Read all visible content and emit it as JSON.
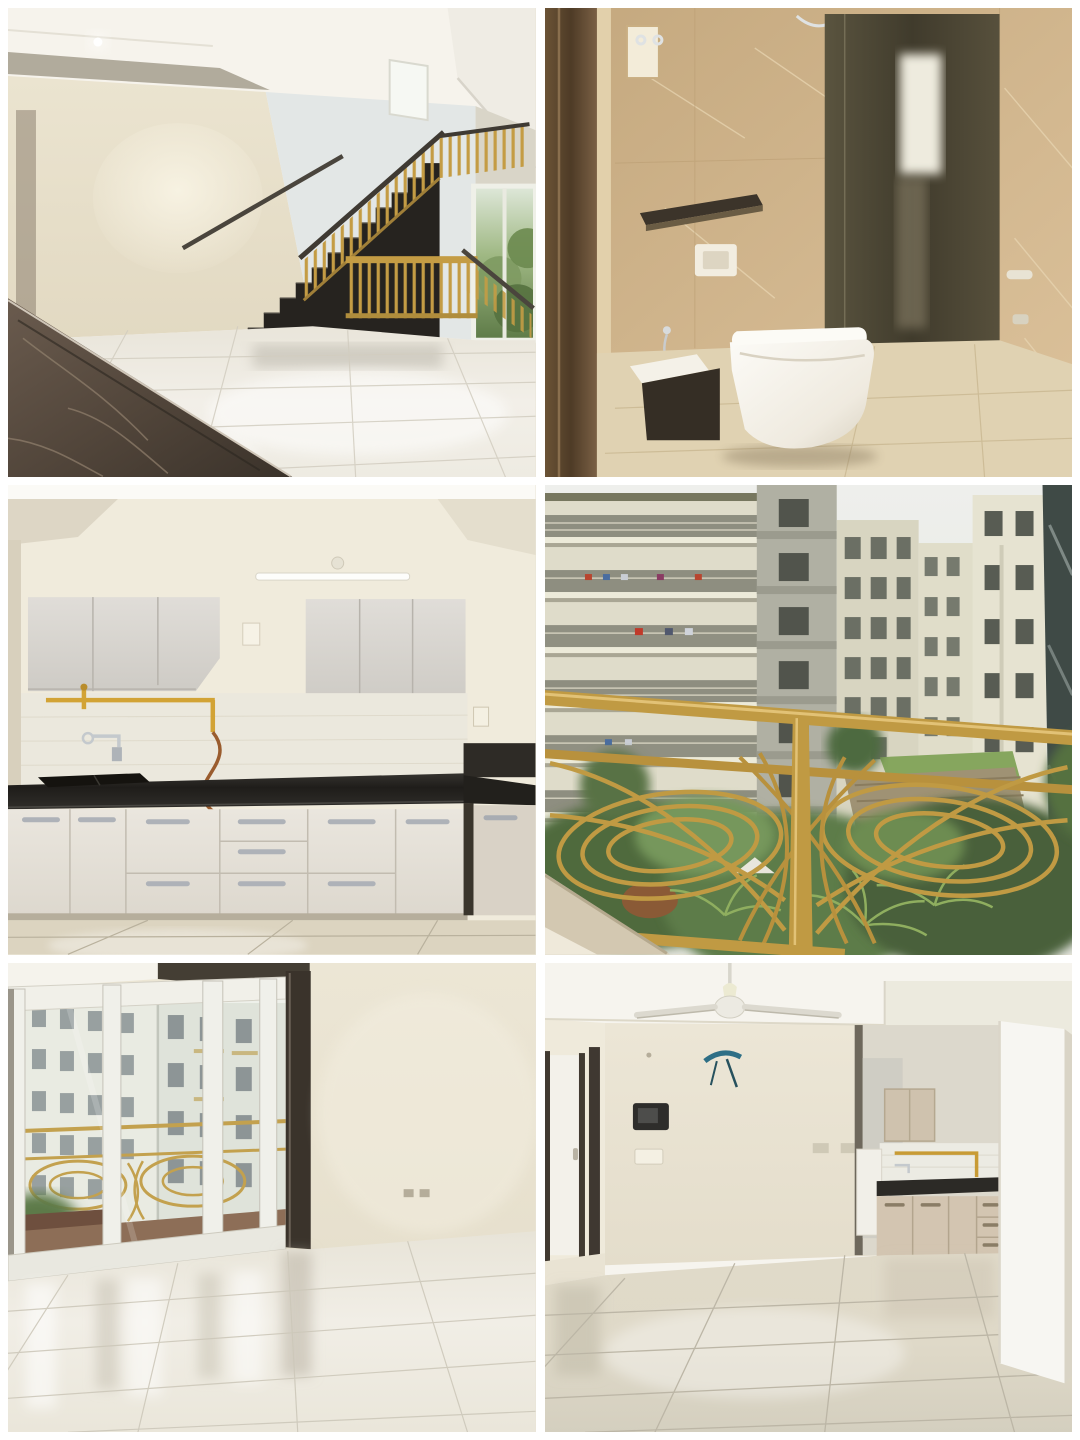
{
  "page": {
    "title": "Apartment listing photo collage",
    "type": "photo-collage",
    "background_color": "#ffffff",
    "grid": {
      "rows": 3,
      "columns": 2,
      "outer_border_px": 8,
      "gutter_px": 9
    }
  },
  "panels": [
    {
      "id": "living-hall-staircase",
      "position": "top-left",
      "description": "Empty duplex living hall with glossy white tile floor, dark brown marble inlay in the corner, cream walls with cove ceiling and downlight, black staircase with golden balustrade and a window showing greenery",
      "colors": {
        "wall": "#ece5d1",
        "ceiling": "#f6f3ec",
        "floor": "#f1eee6",
        "stairs": "#26231f",
        "railing_gold": "#c49c44",
        "marble": "#4e4339",
        "window_green": "#7e9a62"
      }
    },
    {
      "id": "bathroom",
      "position": "top-right",
      "description": "Bathroom with beige marble wall tiles, wall-hung white toilet, dark granite niche shelf, dark glass shower partition reflecting a bright window, and dark wooden door jamb",
      "colors": {
        "tile": "#cdb186",
        "glass": "#4b4636",
        "toilet": "#f7f5ef",
        "granite": "#39322a",
        "floor": "#e0d2b2",
        "door_jamb": "#5a452f"
      }
    },
    {
      "id": "kitchen",
      "position": "middle-left",
      "description": "Modular kitchen with light wood-grain upper and lower cabinets, chrome handles, black granite countertop with sink, wall-mounted chrome tap, yellow gas pipeline with copper hose, tube light and beige tiled floor",
      "colors": {
        "wall": "#f0ebdc",
        "cabinet": "#dedbd6",
        "counter": "#23211e",
        "gas_pipe": "#d2a335",
        "hose": "#9a5c2e",
        "handle": "#aeb2b8",
        "floor": "#dcd4c0"
      }
    },
    {
      "id": "balcony-view",
      "position": "middle-right",
      "description": "View from a balcony with ornate golden wrought railing over a green landscaped courtyard with palm trees and pergolas, surrounded by cream high-rise apartment towers under an overcast sky",
      "colors": {
        "railing_gold": "#c09a43",
        "buildings": "#dfdcca",
        "greenery": "#55713f",
        "sky": "#ecedea",
        "ledge": "#d3c8b1"
      }
    },
    {
      "id": "room-sliding-door",
      "position": "bottom-left",
      "description": "Empty room with glossy cream tile floor reflecting white aluminium sliding glass doors that open to a balcony with golden railing and a view of white apartment towers",
      "colors": {
        "wall": "#ebe5d3",
        "frame": "#f0f0ea",
        "dark_post": "#3a332b",
        "buildings": "#eef0ea",
        "balcony_floor": "#8d6e57",
        "floor": "#f0ede4"
      }
    },
    {
      "id": "living-dining-kitchen",
      "position": "bottom-right",
      "description": "Empty living and dining area with ceiling fan, protruding blue TV-point wires, video door phone on the wall, hallway with dark door frames, open kitchen with beige cabinets and black counter, and a bright white column",
      "colors": {
        "wall": "#eae4d2",
        "ceiling": "#f6f4ee",
        "fan": "#e8e6df",
        "door_frame": "#3f3831",
        "cabinet": "#d3c5b1",
        "counter": "#2c2a26",
        "column": "#f7f6f2",
        "floor": "#dfd9c8",
        "wire": "#2e6f86"
      }
    }
  ]
}
